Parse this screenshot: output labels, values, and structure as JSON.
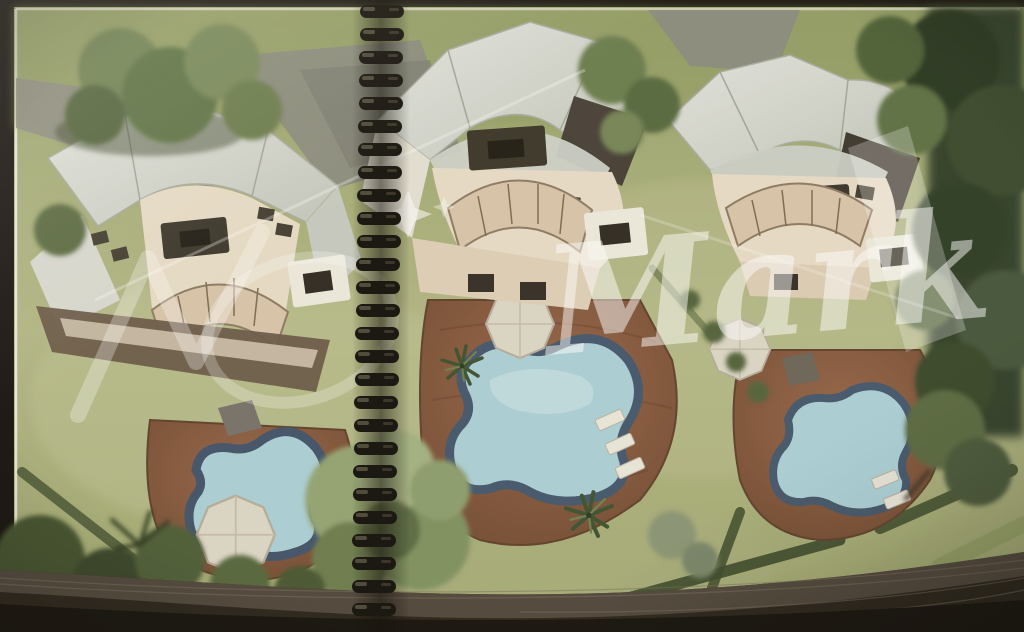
{
  "watermark": {
    "text": "Mark"
  },
  "palette": {
    "lawn_light": "#b2b685",
    "lawn_dark": "#98a26b",
    "roof_light": "#e2e4de",
    "roof_dark": "#c3c6bd",
    "terrace": "#e7dcc8",
    "glass_band": "#d8c5ab",
    "deck_light": "#96654a",
    "deck_dark": "#6e4830",
    "pool_water": "#abd0d8",
    "pool_edge": "#44576d",
    "tree_dark": "#33402a",
    "tree_mid": "#6b7d4f",
    "binding_ring": "#14110d",
    "photo_border": "#17130f",
    "bottom_band": "#2a241c",
    "page_stack": "#544b40",
    "margin_line": "#eae6da"
  }
}
